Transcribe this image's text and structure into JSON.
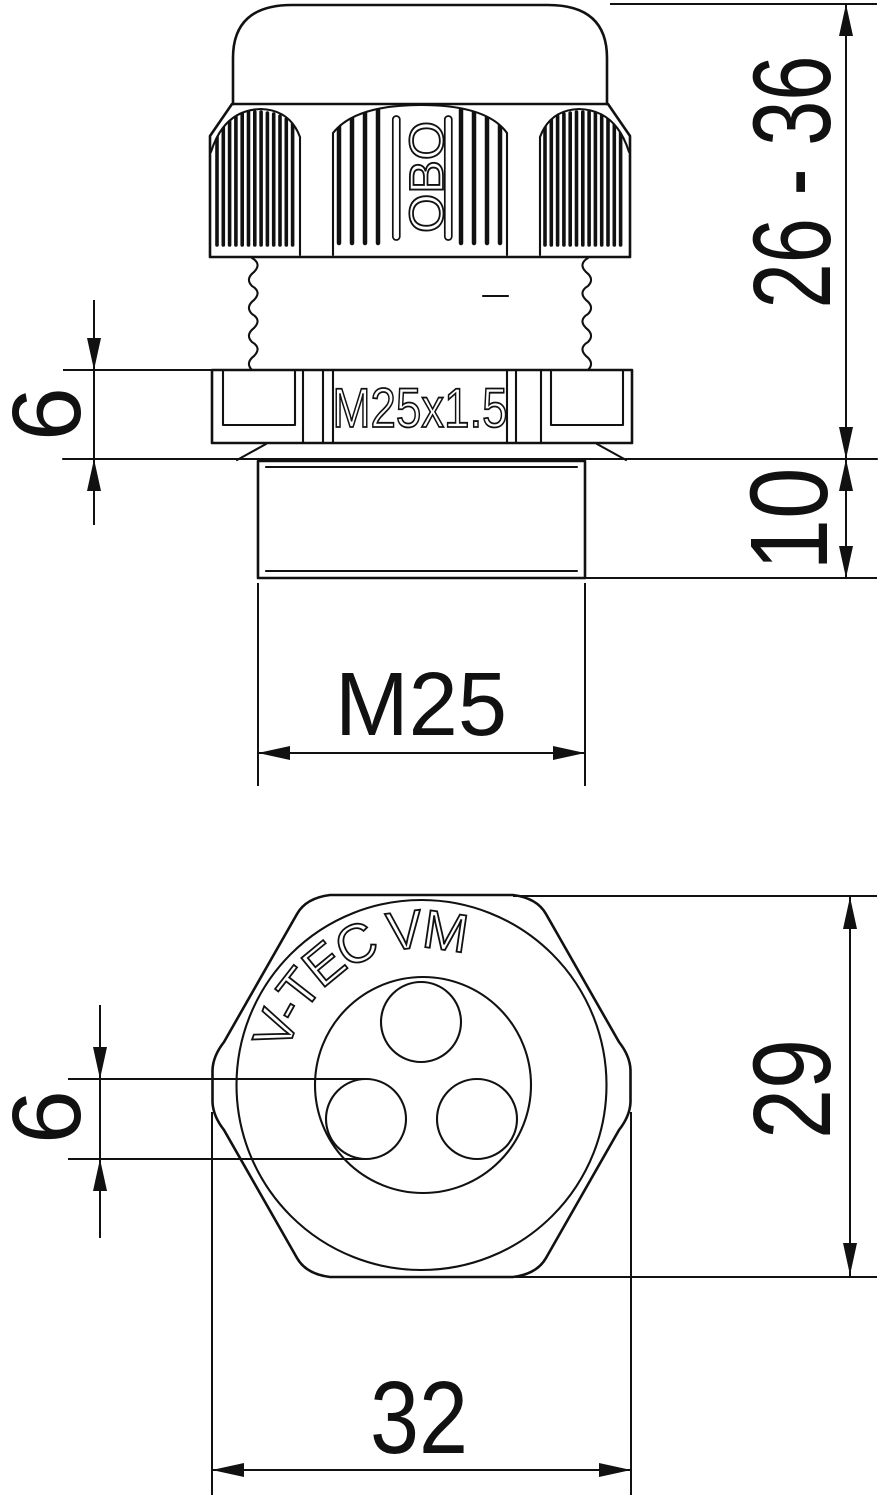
{
  "title": "Cable gland technical drawing",
  "side_view": {
    "brand_marking": "OBO",
    "thread_marking": "M25x1.5",
    "dims": {
      "clamping_range": "26 - 36",
      "nut_height": "6",
      "neck_length": "10",
      "thread_size": "M25"
    }
  },
  "bottom_view": {
    "product_marking": "V-TEC VM",
    "dims": {
      "hole_diameter": "6",
      "across_flats": "29",
      "outer_diameter": "32"
    }
  },
  "colors": {
    "line": "#111111",
    "paper": "#ffffff"
  }
}
